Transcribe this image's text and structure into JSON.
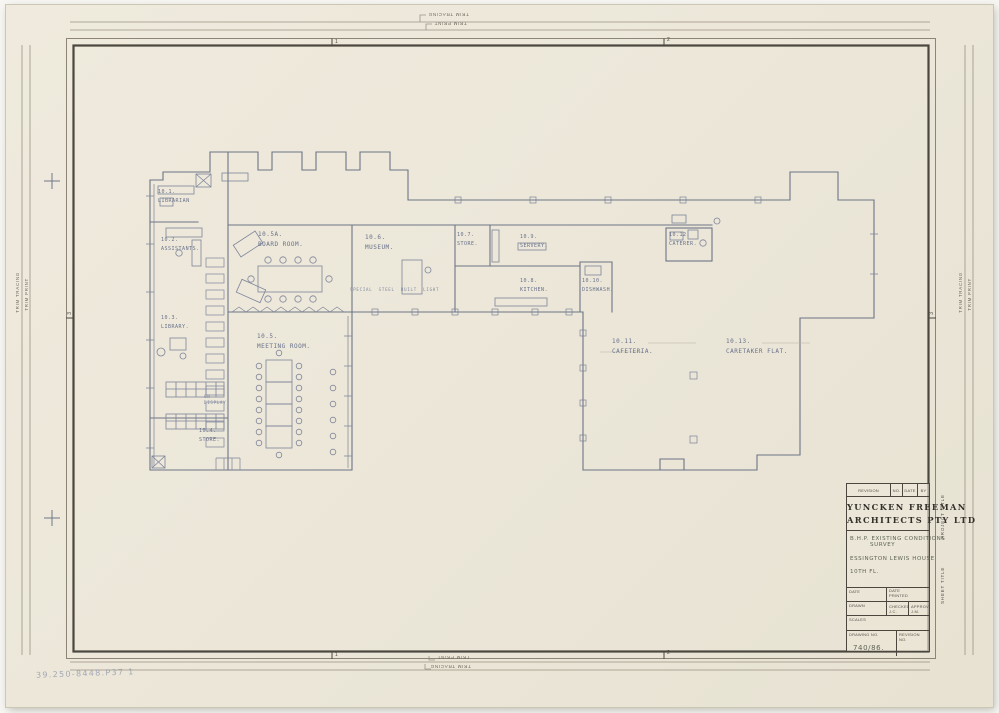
{
  "document": {
    "firm_line1": "YUNCKEN FREEMAN",
    "firm_line2": "ARCHITECTS PTY LTD",
    "revision_header": {
      "revision": "REVISION",
      "no": "NO.",
      "date": "DATE",
      "by": "BY"
    },
    "project_title_line1": "B.H.P.  EXISTING CONDITIONS",
    "project_title_line2": "SURVEY",
    "sheet_title_line1": "ESSINGTON LEWIS HOUSE",
    "sheet_title_line2": "10TH FL.",
    "fields": {
      "date_label": "DATE",
      "date_value": "23.11.67",
      "date_printed_label": "DATE PRINTED",
      "drawn_label": "DRAWN",
      "drawn_value": "MW",
      "checked_label": "CHECKED  J.C.",
      "approved_label": "APPROVED  J.M.",
      "scales_label": "SCALES",
      "scales_value": "1/8\" = 1'-0\"",
      "drawing_no_label": "DRAWING NO.",
      "drawing_no_value": "740/86.",
      "revision_no_label": "REVISION NO."
    },
    "side_labels": {
      "project_title": "PROJECT TITLE",
      "sheet_title": "SHEET TITLE"
    }
  },
  "edge": {
    "trim_tracing": "TRIM TRACING",
    "trim_print": "TRIM PRINT",
    "fold_1": "1",
    "fold_2": "2",
    "fold_3": "3"
  },
  "rooms": [
    {
      "id": "10.1.",
      "name": "LIBRARIAN"
    },
    {
      "id": "10.2.",
      "name": "ASSISTANTS."
    },
    {
      "id": "10.3.",
      "name": "LIBRARY."
    },
    {
      "id": "10.4.",
      "name": "STORE."
    },
    {
      "id": "10.5.",
      "name": "MEETING ROOM."
    },
    {
      "id": "10.5A.",
      "name": "BOARD ROOM."
    },
    {
      "id": "10.6.",
      "name": "MUSEUM."
    },
    {
      "id": "10.7.",
      "name": "STORE."
    },
    {
      "id": "10.8.",
      "name": "KITCHEN."
    },
    {
      "id": "10.9.",
      "name": "SERVERY."
    },
    {
      "id": "10.10.",
      "name": "DISHWASH."
    },
    {
      "id": "10.11.",
      "name": "CAFETERIA."
    },
    {
      "id": "10.12.",
      "name": "CATERER."
    },
    {
      "id": "10.13.",
      "name": "CARETAKER FLAT."
    }
  ],
  "annotations": {
    "corridor_note": "SPECIAL STEEL BUILT LIGHT",
    "on_display": "ON DISPLAY",
    "archive_number": "39.250-8448.P37 1"
  },
  "colors": {
    "paper": "#ece7d9",
    "plan_line": "#6d7486",
    "frame": "#4b473e",
    "pencil_note": "#5d6455"
  }
}
